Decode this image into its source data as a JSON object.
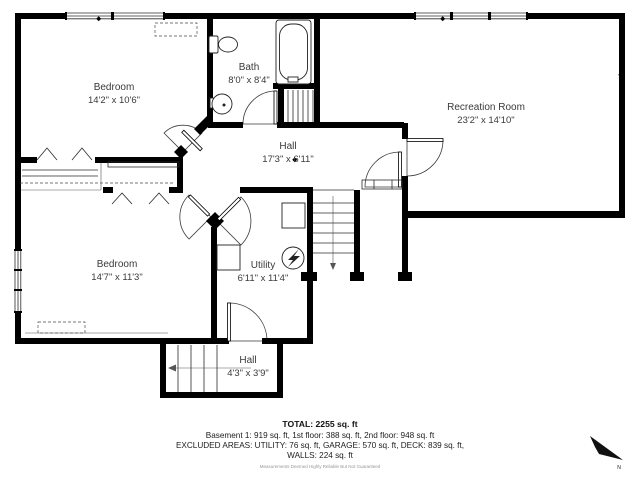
{
  "plan": {
    "rooms": [
      {
        "name": "Bedroom",
        "dims": "14'2\" x 10'6\""
      },
      {
        "name": "Bath",
        "dims": "8'0\" x 8'4\""
      },
      {
        "name": "Recreation Room",
        "dims": "23'2\" x 14'10\""
      },
      {
        "name": "Hall",
        "dims": "17'3\" x 6'11\""
      },
      {
        "name": "Bedroom",
        "dims": "14'7\" x 11'3\""
      },
      {
        "name": "Utility",
        "dims": "6'11\" x 11'4\""
      },
      {
        "name": "Hall",
        "dims": "4'3\" x 3'9\""
      }
    ],
    "compass": {
      "label": "N"
    }
  },
  "summary": {
    "total": "TOTAL: 2255 sq. ft",
    "floors": "Basement 1: 919 sq. ft, 1st floor: 388 sq. ft, 2nd floor: 948 sq. ft",
    "excluded": "EXCLUDED AREAS: UTILITY: 76 sq. ft, GARAGE: 570 sq. ft, DECK: 839 sq. ft,",
    "walls": "WALLS: 224 sq. ft",
    "disclaimer": "Measurements Deemed Highly Reliable But Not Guaranteed"
  },
  "colors": {
    "wall": "#000000",
    "label_text": "#3a3a3a",
    "disclaimer_text": "#979797"
  }
}
